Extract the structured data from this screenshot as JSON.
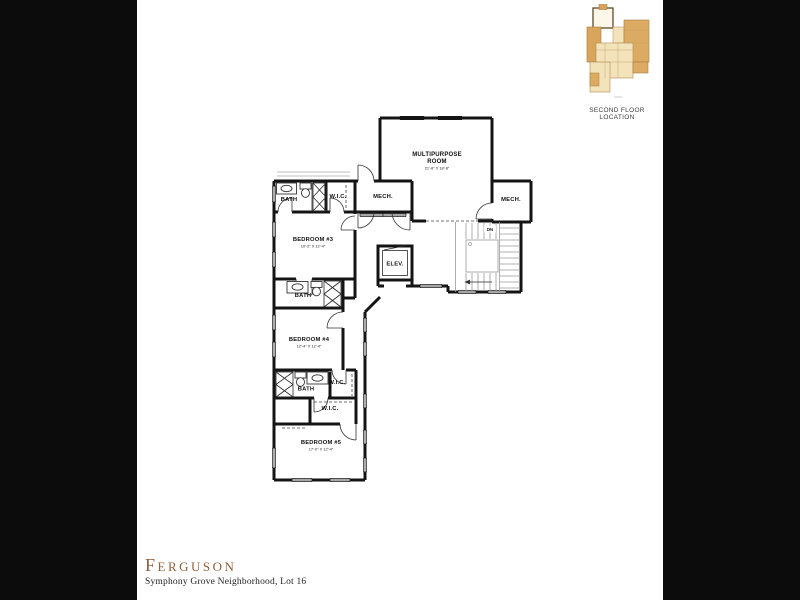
{
  "page": {
    "background_color": "#0c0c0c",
    "paper_color": "#ffffff"
  },
  "locator": {
    "caption": "SECOND FLOOR LOCATION",
    "highlight_color": "#d9a55c",
    "light_color": "#f2e3ba"
  },
  "title_block": {
    "title": "Ferguson",
    "subtitle": "Symphony Grove Neighborhood, Lot 16",
    "title_color": "#8d5f3d"
  },
  "floor_plan": {
    "rooms": {
      "multipurpose": {
        "name_line1": "MULTIPURPOSE",
        "name_line2": "ROOM",
        "dims": "21'-8\" X 18'-8\""
      },
      "mech_left": {
        "name": "MECH."
      },
      "mech_right": {
        "name": "MECH."
      },
      "bath_top": {
        "name": "BATH"
      },
      "wic_top": {
        "name": "W.I.C."
      },
      "bedroom3": {
        "name": "BEDROOM #3",
        "dims": "10'-2\" X 12'-4\""
      },
      "elevator": {
        "name": "ELEV."
      },
      "stairs": {
        "label": "DN"
      },
      "bath_mid": {
        "name": "BATH"
      },
      "bedroom4": {
        "name": "BEDROOM #4",
        "dims": "12'-4\" X 12'-4\""
      },
      "bath_lower": {
        "name": "BATH"
      },
      "wic_mid": {
        "name": "W.I.C."
      },
      "wic_lower": {
        "name": "W.I.C."
      },
      "bedroom5": {
        "name": "BEDROOM #5",
        "dims": "17'-0\" X 12'-4\""
      }
    }
  }
}
